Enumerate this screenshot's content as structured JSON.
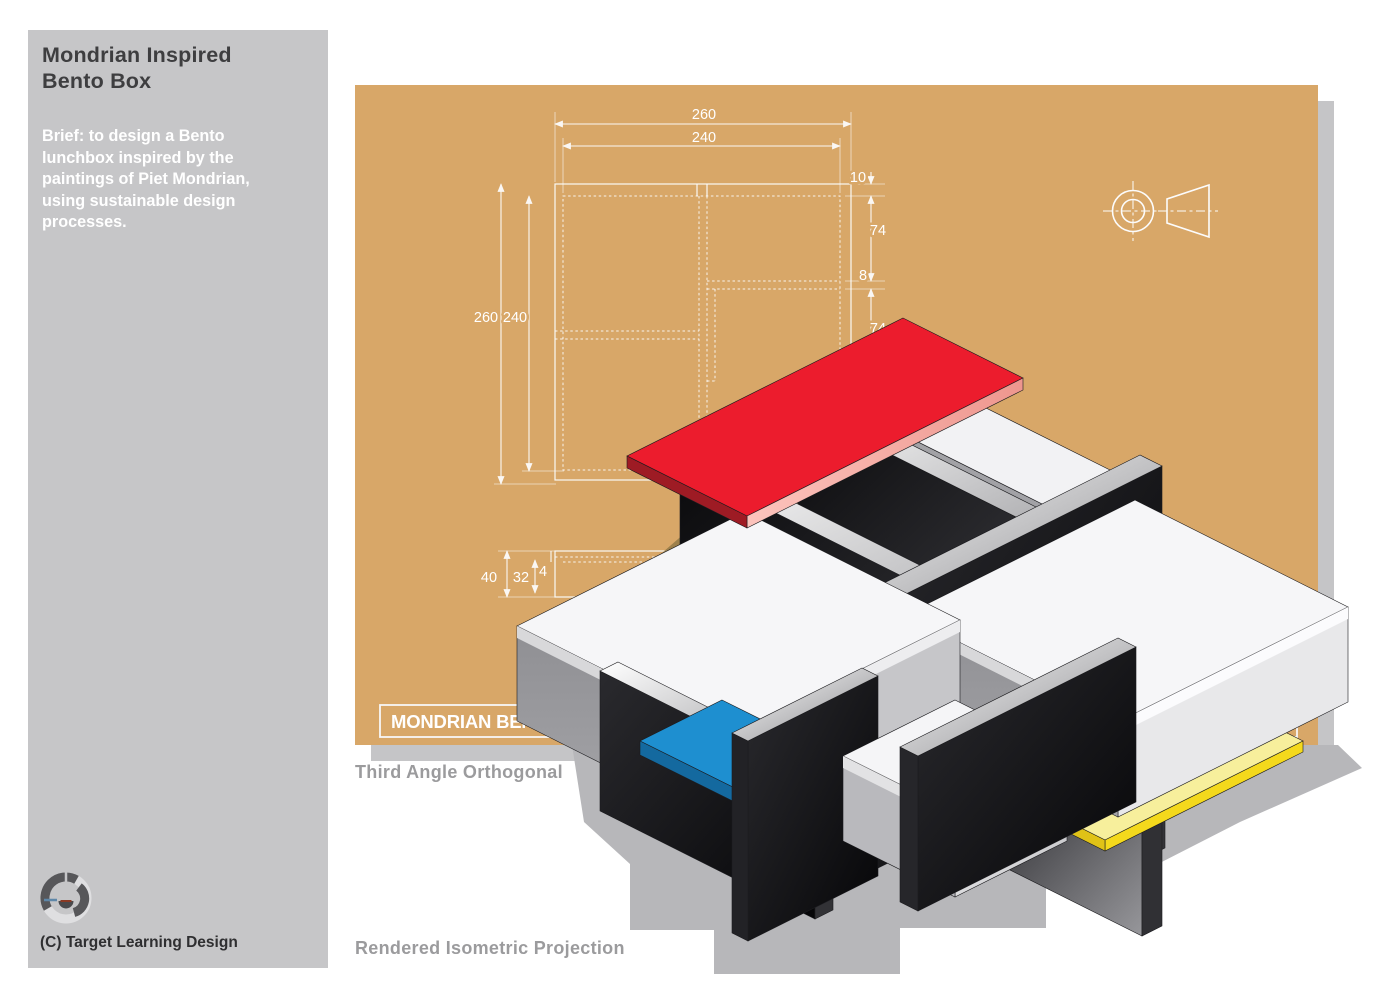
{
  "sidebar": {
    "title": "Mondrian Inspired\nBento Box",
    "brief": "Brief: to design a Bento lunchbox inspired by the paintings of Piet Mondrian, using sustainable design processes.",
    "copyright": "(C) Target Learning Design",
    "background": "#c6c6c8"
  },
  "captions": {
    "orthogonal": "Third Angle Orthogonal",
    "isometric": "Rendered Isometric Projection"
  },
  "board": {
    "background": "#d8a768",
    "line_color": "#fcfcfc",
    "title_bar": "MONDRIAN BENTO BOX",
    "title_bar_right": "23",
    "view_label_partial": "TOP",
    "dims": {
      "top_outer": "260",
      "top_inner": "240",
      "left_outer": "260",
      "left_inner": "240",
      "right_lip": "10",
      "right_upper": "74",
      "right_wall": "8",
      "right_lower": "74",
      "side_depth": "40",
      "side_inner": "32",
      "side_lip": "4"
    }
  },
  "iso_colors": {
    "red": "#ec1c2d",
    "red_edge_dark": "#9e1b24",
    "red_edge_light": "#f3a39b",
    "blue": "#1e8fd0",
    "yellow_top": "#f7ef9c",
    "yellow_edge": "#f4d91c",
    "tray_white": "#f6f6f8",
    "divider_black": "#0b0b0d",
    "shadow_page": "#b7b7ba",
    "shadow_board": "#8f7743"
  },
  "icons": {
    "logo": "target-learning-rings-logo",
    "projection_symbol": "third-angle-projection-icon"
  }
}
